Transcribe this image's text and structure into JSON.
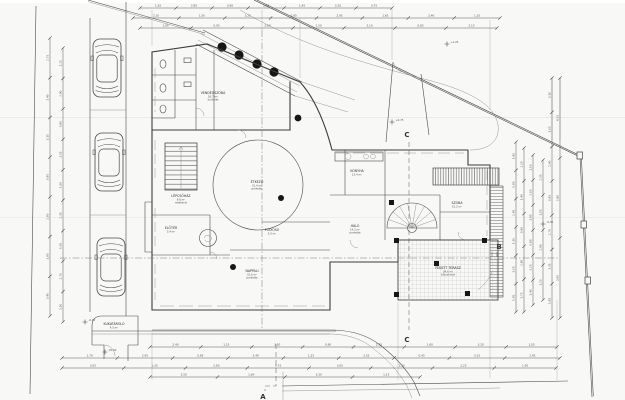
{
  "markers": {
    "a": "A",
    "b": "B",
    "c": "C"
  },
  "rooms": [
    {
      "name": "VENDÉGSZOBA",
      "area": "26,7 m²",
      "floor": "burkolat"
    },
    {
      "name": "LÉPCSŐHÁZ",
      "area": "9,6 m²",
      "floor": "mettlachi"
    },
    {
      "name": "ELŐTÉR",
      "area": "3,4 m²",
      "floor": "mettlachi"
    },
    {
      "name": "ÉTKEZŐ",
      "area": "31,4 m²",
      "floor": "parketta"
    },
    {
      "name": "FOLYOSÓ",
      "area": "5,5 m²",
      "floor": "mettlachi"
    },
    {
      "name": "NAPPALI",
      "area": "32,6 m²",
      "floor": "parketta"
    },
    {
      "name": "KONYHA",
      "area": "12,4 m²",
      "floor": "mettlachi"
    },
    {
      "name": "HÁLÓ",
      "area": "14,3 m²",
      "floor": "parketta"
    },
    {
      "name": "SZOBA",
      "area": "15,2 m²",
      "floor": "parketta"
    },
    {
      "name": "FEDETT TERASZ",
      "area": "34,6 m²",
      "floor": "kőburkolat"
    },
    {
      "name": "KUKATÁROLÓ",
      "area": "4,5 m²",
      "floor": ""
    }
  ],
  "elevations": [
    {
      "label": "-0,45"
    },
    {
      "label": "±0,00"
    },
    {
      "label": "+1,25"
    },
    {
      "label": "-0,30"
    },
    {
      "label": "+0,75"
    }
  ],
  "dims": {
    "top_row1": [
      "1,20",
      "2,85",
      "0,90",
      "3,60",
      "1,45",
      "2,20",
      "0,75"
    ],
    "top_row2": [
      "2,10",
      "1,50",
      "3,25",
      "0,80",
      "2,95",
      "1,65",
      "2,40",
      "1,10"
    ],
    "top_row3": [
      "1,85",
      "0,95",
      "2,60",
      "1,30",
      "3,10",
      "0,85",
      "2,15"
    ],
    "bottom_row1": [
      "2,40",
      "1,15",
      "3,50",
      "0,90",
      "2,75",
      "1,60",
      "3,20",
      "1,05"
    ],
    "bottom_row2": [
      "1,70",
      "2,95",
      "0,85",
      "3,40",
      "1,25",
      "2,55",
      "0,95",
      "3,15",
      "1,45"
    ],
    "bottom_row3": [
      "3,05",
      "1,35",
      "2,80",
      "0,75",
      "3,65",
      "1,50",
      "2,25",
      "1,90"
    ],
    "bottom_row4": [
      "2,50",
      "1,80",
      "3,30",
      "1,15"
    ],
    "left_col1": [
      "2,75",
      "1,40",
      "3,15",
      "0,95",
      "2,60",
      "1,85",
      "3,45"
    ],
    "left_col2": [
      "1,25",
      "2,90",
      "0,80",
      "3,55",
      "1,60",
      "2,35",
      "1,05",
      "2,70",
      "1,50"
    ],
    "right_col1": [
      "1,90",
      "0,85",
      "2,45",
      "1,30",
      "3,05",
      "1,65"
    ],
    "right_col2": [
      "2,20",
      "1,45",
      "0,90",
      "2,85",
      "1,75"
    ],
    "right_col3": [
      "1,10",
      "2,65",
      "1,95",
      "0,80",
      "3,25",
      "1,40"
    ],
    "right_col4": [
      "2,35",
      "1,55",
      "2,90",
      "1,20"
    ],
    "right_col5": [
      "3,10",
      "1,65",
      "2,40",
      "0,95",
      "2,75",
      "1,35",
      "1,85"
    ],
    "right_col6": [
      "4,25",
      "2,80",
      "3,60"
    ]
  },
  "colors": {
    "paper": "#f8f8f6",
    "ink": "#3c3c3c",
    "faint": "#9a9a9a"
  }
}
